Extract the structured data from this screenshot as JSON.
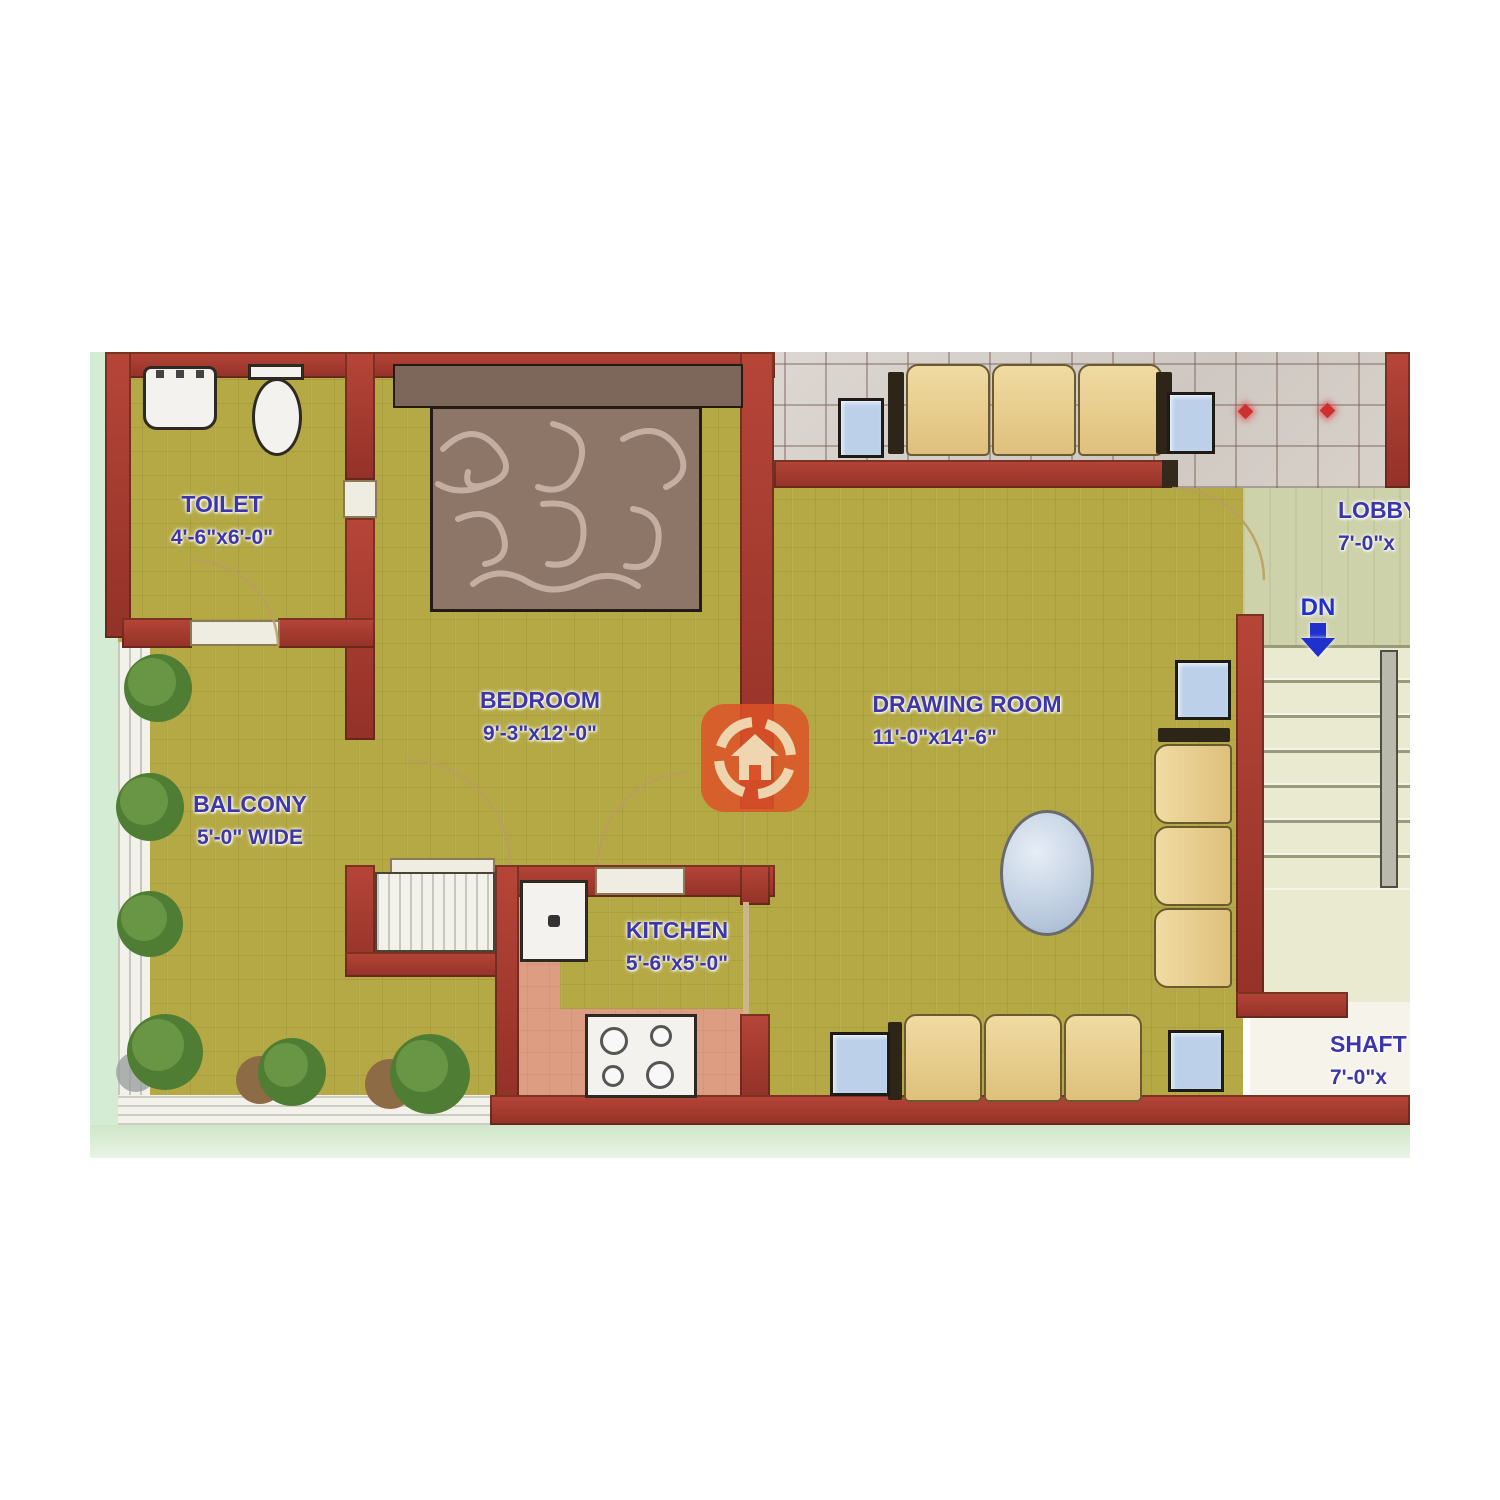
{
  "plan_title": "apartment-floor-plan",
  "rooms": {
    "toilet": {
      "name": "TOILET",
      "dims": "4'-6\"x6'-0\""
    },
    "bedroom": {
      "name": "BEDROOM",
      "dims": "9'-3\"x12'-0\""
    },
    "balcony": {
      "name": "BALCONY",
      "dims": "5'-0\" WIDE"
    },
    "kitchen": {
      "name": "KITCHEN",
      "dims": "5'-6\"x5'-0\""
    },
    "drawing_room": {
      "name": "DRAWING ROOM",
      "dims": "11'-0\"x14'-6\""
    },
    "lobby": {
      "name": "LOBBY",
      "dims": "7'-0\"x"
    },
    "shaft": {
      "name": "SHAFT",
      "dims": "7'-0\"x"
    }
  },
  "stairs": {
    "down_label": "DN"
  },
  "icons": {
    "stairs_down": "down-arrow-icon",
    "watermark": "house-target-logo"
  },
  "colors": {
    "floor_olive": "#b4a944",
    "wall_red": "#a63a30",
    "label_blue": "#3c36aa",
    "tile_gray": "#d6d2cc",
    "lobby_sage": "#ced2aa",
    "kitchen_pink": "#dd9d82",
    "stair_tread": "#e9ead0",
    "exterior_green": "#d5ecd4",
    "arrow_blue": "#2030cc",
    "watermark_orange": "#dd5227"
  }
}
